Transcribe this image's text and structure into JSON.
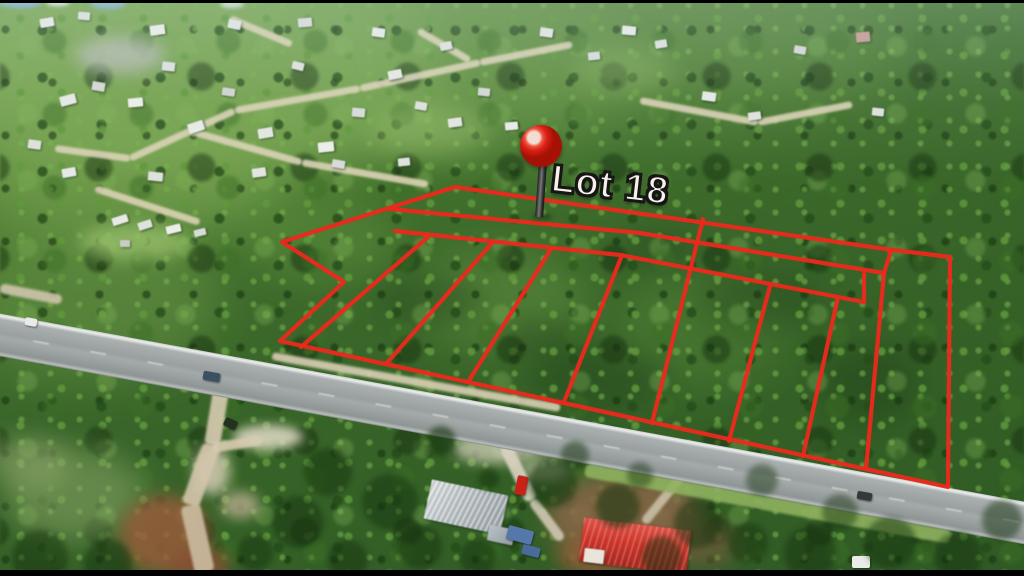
{
  "annotation": {
    "lot_label": "Lot 18",
    "label_color": "#f7f3ea",
    "label_outline_color": "#161616",
    "label_pos": {
      "x": 554,
      "y": 158,
      "rotate_deg": 6.5,
      "font_size": 38
    },
    "line_color": "#ea2a1d",
    "line_width": 4.2,
    "pin": {
      "icon": "map-pin-icon",
      "ball_color": "#d92114",
      "highlight_color": "#f3ddd3",
      "stem_color": "#3a3a3a",
      "cx": 541,
      "cy": 146,
      "r": 21,
      "stem_top": 163,
      "stem_bottom": 217
    },
    "outer_boundary": [
      [
        455,
        187
      ],
      [
        893,
        250
      ],
      [
        950,
        257
      ],
      [
        948,
        487
      ],
      [
        280,
        341
      ],
      [
        344,
        282
      ],
      [
        282,
        242
      ]
    ],
    "interior_lines": [
      [
        [
          390,
          209
        ],
        [
          640,
          233
        ],
        [
          884,
          273
        ]
      ],
      [
        [
          891,
          251
        ],
        [
          884,
          273
        ]
      ],
      [
        [
          395,
          231
        ],
        [
          620,
          255
        ],
        [
          864,
          302
        ]
      ],
      [
        [
          864,
          274
        ],
        [
          864,
          302
        ]
      ],
      [
        [
          703,
          219
        ],
        [
          652,
          423
        ]
      ],
      [
        [
          428,
          237
        ],
        [
          301,
          347
        ]
      ],
      [
        [
          492,
          243
        ],
        [
          386,
          364
        ]
      ],
      [
        [
          551,
          249
        ],
        [
          468,
          382
        ]
      ],
      [
        [
          622,
          255
        ],
        [
          564,
          402
        ]
      ],
      [
        [
          770,
          286
        ],
        [
          729,
          441
        ]
      ],
      [
        [
          838,
          297
        ],
        [
          803,
          456
        ]
      ],
      [
        [
          884,
          273
        ],
        [
          866,
          469
        ]
      ]
    ]
  },
  "scenery": {
    "road": {
      "x": -20,
      "y": 310,
      "len": 1104,
      "w": 42,
      "angle_deg": 10.4
    },
    "patches": [
      [
        180,
        70,
        260,
        120,
        "#7fab55",
        0.8,
        30,
        1
      ],
      [
        460,
        60,
        180,
        90,
        "#74a24e",
        0.55,
        30,
        1
      ],
      [
        700,
        50,
        200,
        70,
        "#628f42",
        0.5,
        30,
        1
      ],
      [
        120,
        180,
        160,
        70,
        "#79a552",
        0.55,
        25,
        1
      ],
      [
        90,
        300,
        130,
        80,
        "#6d9749",
        0.5,
        25,
        1
      ],
      [
        500,
        300,
        90,
        50,
        "#6d9c47",
        0.4,
        20,
        1
      ],
      [
        700,
        330,
        90,
        60,
        "#5e8f3e",
        0.35,
        20,
        1
      ],
      [
        320,
        240,
        80,
        40,
        "#6d9c47",
        0.35,
        18,
        1
      ],
      [
        600,
        380,
        70,
        30,
        "#23431c",
        0.45,
        15,
        1
      ],
      [
        760,
        300,
        60,
        30,
        "#23431c",
        0.4,
        15,
        1
      ],
      [
        430,
        300,
        50,
        25,
        "#23431c",
        0.4,
        12,
        1
      ],
      [
        870,
        385,
        50,
        40,
        "#1f3d18",
        0.4,
        14,
        1
      ],
      [
        660,
        250,
        40,
        20,
        "#23431c",
        0.35,
        12,
        1
      ],
      [
        540,
        340,
        40,
        22,
        "#23431c",
        0.35,
        12,
        1
      ],
      [
        135,
        242,
        55,
        18,
        "#9ec46f",
        0.7,
        8,
        3
      ],
      [
        120,
        55,
        45,
        18,
        "#b6bab1",
        0.8,
        8,
        3
      ],
      [
        430,
        130,
        60,
        25,
        "#97bd68",
        0.5,
        12,
        3
      ],
      [
        625,
        70,
        50,
        22,
        "#8fb763",
        0.4,
        12,
        3
      ],
      [
        75,
        495,
        70,
        45,
        "#8aa768",
        0.55,
        15,
        3
      ],
      [
        28,
        462,
        40,
        25,
        "#98ad74",
        0.5,
        12,
        3
      ],
      [
        268,
        437,
        35,
        12,
        "#e3dbc8",
        0.85,
        5,
        3
      ],
      [
        212,
        470,
        18,
        25,
        "#ddd2bc",
        0.8,
        6,
        3
      ],
      [
        165,
        535,
        45,
        40,
        "#9c5c3c",
        0.8,
        8,
        3
      ],
      [
        200,
        565,
        30,
        18,
        "#8a4f34",
        0.75,
        6,
        3
      ],
      [
        240,
        505,
        20,
        14,
        "#c8b89a",
        0.7,
        6,
        3
      ],
      [
        625,
        518,
        78,
        45,
        "#8a6648",
        0.85,
        10,
        3
      ],
      [
        598,
        556,
        42,
        20,
        "#9b5b3a",
        0.7,
        8,
        3
      ],
      [
        700,
        545,
        40,
        22,
        "#7d5c40",
        0.6,
        10,
        3
      ],
      [
        497,
        448,
        45,
        16,
        "#ded7c4",
        0.7,
        6,
        3
      ],
      [
        545,
        470,
        25,
        12,
        "#d5cdb8",
        0.6,
        6,
        3
      ],
      [
        20,
        2,
        22,
        6,
        "#86b3d6",
        0.9,
        2,
        3
      ],
      [
        108,
        3,
        18,
        6,
        "#8ab6d8",
        0.85,
        2,
        3
      ],
      [
        58,
        2,
        12,
        4,
        "#e8eef2",
        0.9,
        2,
        3
      ],
      [
        232,
        4,
        12,
        4,
        "#dfe7ec",
        0.8,
        2,
        3
      ]
    ],
    "streets": [
      [
        55,
        148,
        130,
        158
      ],
      [
        130,
        158,
        235,
        110
      ],
      [
        235,
        110,
        360,
        88
      ],
      [
        360,
        88,
        480,
        62
      ],
      [
        480,
        62,
        572,
        44
      ],
      [
        188,
        130,
        302,
        162
      ],
      [
        302,
        162,
        428,
        184
      ],
      [
        95,
        188,
        200,
        222
      ],
      [
        230,
        18,
        292,
        44
      ],
      [
        418,
        30,
        470,
        60
      ],
      [
        640,
        100,
        758,
        122
      ],
      [
        758,
        122,
        852,
        104
      ]
    ],
    "trails": [
      [
        222,
        385,
        212,
        445,
        16,
        "#d8ccb2"
      ],
      [
        212,
        445,
        190,
        505,
        18,
        "#d4c6ac"
      ],
      [
        190,
        505,
        205,
        572,
        20,
        "#cdbda2"
      ],
      [
        212,
        448,
        262,
        440,
        10,
        "#d8ccb2"
      ],
      [
        505,
        445,
        532,
        500,
        13,
        "#dad3c1"
      ],
      [
        532,
        500,
        562,
        540,
        10,
        "#d0c8b4"
      ],
      [
        688,
        468,
        644,
        522,
        9,
        "#cabfa6"
      ],
      [
        0,
        288,
        62,
        300,
        10,
        "#cfc5ab"
      ],
      [
        272,
        356,
        560,
        408,
        8,
        "#d9cfb4"
      ],
      [
        585,
        470,
        950,
        537,
        14,
        "#8fb25f"
      ]
    ],
    "houses": [
      [
        40,
        18,
        14,
        9,
        -10,
        "#e8ebe7"
      ],
      [
        78,
        12,
        12,
        8,
        5,
        "#dde1dc"
      ],
      [
        150,
        25,
        15,
        10,
        -8,
        "#eceee9"
      ],
      [
        228,
        20,
        13,
        9,
        12,
        "#e2e6e1"
      ],
      [
        298,
        18,
        14,
        9,
        -5,
        "#d8dcd8"
      ],
      [
        372,
        28,
        13,
        9,
        8,
        "#e8ebe7"
      ],
      [
        440,
        42,
        12,
        8,
        -12,
        "#dfe3de"
      ],
      [
        60,
        95,
        16,
        10,
        -15,
        "#e6e9e5"
      ],
      [
        92,
        82,
        13,
        9,
        10,
        "#d4d8d3"
      ],
      [
        128,
        98,
        15,
        9,
        -5,
        "#eceee9"
      ],
      [
        162,
        62,
        13,
        9,
        6,
        "#dde1dc"
      ],
      [
        188,
        122,
        16,
        10,
        -18,
        "#e8ebe7"
      ],
      [
        222,
        88,
        13,
        8,
        8,
        "#cfd4cf"
      ],
      [
        258,
        128,
        15,
        10,
        -10,
        "#e4e7e2"
      ],
      [
        292,
        62,
        12,
        8,
        14,
        "#dde1dc"
      ],
      [
        318,
        142,
        16,
        10,
        -6,
        "#eceee9"
      ],
      [
        352,
        108,
        13,
        9,
        5,
        "#d8dcd8"
      ],
      [
        388,
        70,
        14,
        9,
        -12,
        "#e6e9e5"
      ],
      [
        415,
        102,
        12,
        8,
        10,
        "#dde1dc"
      ],
      [
        448,
        118,
        14,
        9,
        -8,
        "#e2e6e1"
      ],
      [
        478,
        88,
        12,
        8,
        6,
        "#d4d8d3"
      ],
      [
        505,
        122,
        13,
        8,
        -5,
        "#e8ebe7"
      ],
      [
        28,
        140,
        13,
        9,
        8,
        "#dde1dc"
      ],
      [
        62,
        168,
        14,
        9,
        -10,
        "#e6e9e5"
      ],
      [
        148,
        172,
        15,
        9,
        6,
        "#dde1dc"
      ],
      [
        252,
        168,
        14,
        9,
        -8,
        "#e2e6e1"
      ],
      [
        332,
        160,
        13,
        8,
        10,
        "#d8dcd8"
      ],
      [
        398,
        158,
        12,
        8,
        -6,
        "#dfe3de"
      ],
      [
        112,
        216,
        16,
        8,
        -18,
        "#e6e9e6"
      ],
      [
        138,
        221,
        14,
        8,
        -18,
        "#dfe3df"
      ],
      [
        166,
        225,
        15,
        8,
        -14,
        "#eceee9"
      ],
      [
        194,
        229,
        12,
        7,
        -14,
        "#d8dcd8"
      ],
      [
        120,
        240,
        10,
        7,
        0,
        "#c8ccc4"
      ],
      [
        540,
        28,
        13,
        9,
        8,
        "#e2e6e1"
      ],
      [
        588,
        52,
        12,
        8,
        -6,
        "#d8dcd8"
      ],
      [
        622,
        26,
        14,
        9,
        5,
        "#e8ebe7"
      ],
      [
        655,
        40,
        12,
        8,
        -10,
        "#dde1dc"
      ],
      [
        702,
        92,
        14,
        9,
        8,
        "#e6e9e5"
      ],
      [
        748,
        112,
        13,
        8,
        -8,
        "#dfe3de"
      ],
      [
        794,
        46,
        12,
        8,
        10,
        "#d4d8d3"
      ],
      [
        856,
        32,
        14,
        10,
        -5,
        "#c59a90"
      ],
      [
        872,
        108,
        12,
        8,
        6,
        "#dde1dc"
      ]
    ],
    "buildings": [
      {
        "x": 427,
        "y": 487,
        "w": 78,
        "h": 40,
        "rot": 12,
        "cls": "roof-gray",
        "name": "gray-roof-house"
      },
      {
        "x": 488,
        "y": 527,
        "w": 26,
        "h": 16,
        "rot": 12,
        "cls": "roof-gray2",
        "name": "shed"
      },
      {
        "x": 581,
        "y": 524,
        "w": 108,
        "h": 44,
        "rot": 7,
        "cls": "roof-red",
        "name": "red-roof-building"
      },
      {
        "x": 584,
        "y": 549,
        "w": 20,
        "h": 14,
        "rot": 7,
        "cls": "wall-white",
        "name": "building-end-wall"
      }
    ],
    "vehicles": [
      [
        203,
        372,
        17,
        9,
        10,
        "#3c4f63"
      ],
      [
        224,
        419,
        13,
        9,
        25,
        "#25301f"
      ],
      [
        516,
        476,
        11,
        19,
        12,
        "#c92318"
      ],
      [
        857,
        492,
        15,
        8,
        10,
        "#33383b"
      ],
      [
        25,
        318,
        12,
        8,
        10,
        "#e8ebe8"
      ],
      [
        852,
        556,
        18,
        12,
        0,
        "#e9ece9"
      ],
      [
        507,
        528,
        26,
        14,
        15,
        "#5577aa"
      ],
      [
        522,
        546,
        18,
        10,
        15,
        "#4a6a9a"
      ]
    ],
    "trees": [
      [
        441,
        441,
        15,
        0.6
      ],
      [
        489,
        479,
        11,
        0.6
      ],
      [
        553,
        483,
        24,
        0.55
      ],
      [
        618,
        506,
        22,
        0.55
      ],
      [
        698,
        524,
        24,
        0.5
      ],
      [
        748,
        543,
        20,
        0.5
      ],
      [
        390,
        502,
        28,
        0.5
      ],
      [
        328,
        472,
        24,
        0.5
      ],
      [
        298,
        522,
        26,
        0.5
      ],
      [
        420,
        547,
        22,
        0.5
      ],
      [
        478,
        557,
        18,
        0.5
      ],
      [
        662,
        556,
        20,
        0.5
      ],
      [
        810,
        553,
        26,
        0.5
      ],
      [
        890,
        543,
        26,
        0.5
      ],
      [
        958,
        556,
        24,
        0.5
      ],
      [
        1002,
        520,
        20,
        0.5
      ],
      [
        762,
        480,
        16,
        0.45
      ],
      [
        840,
        512,
        18,
        0.45
      ],
      [
        40,
        558,
        28,
        0.5
      ],
      [
        108,
        563,
        24,
        0.5
      ],
      [
        255,
        553,
        18,
        0.5
      ],
      [
        348,
        560,
        20,
        0.5
      ],
      [
        575,
        455,
        14,
        0.5
      ],
      [
        640,
        475,
        13,
        0.45
      ]
    ],
    "letterbox": {
      "top_h": 3,
      "bottom_h": 6
    }
  }
}
